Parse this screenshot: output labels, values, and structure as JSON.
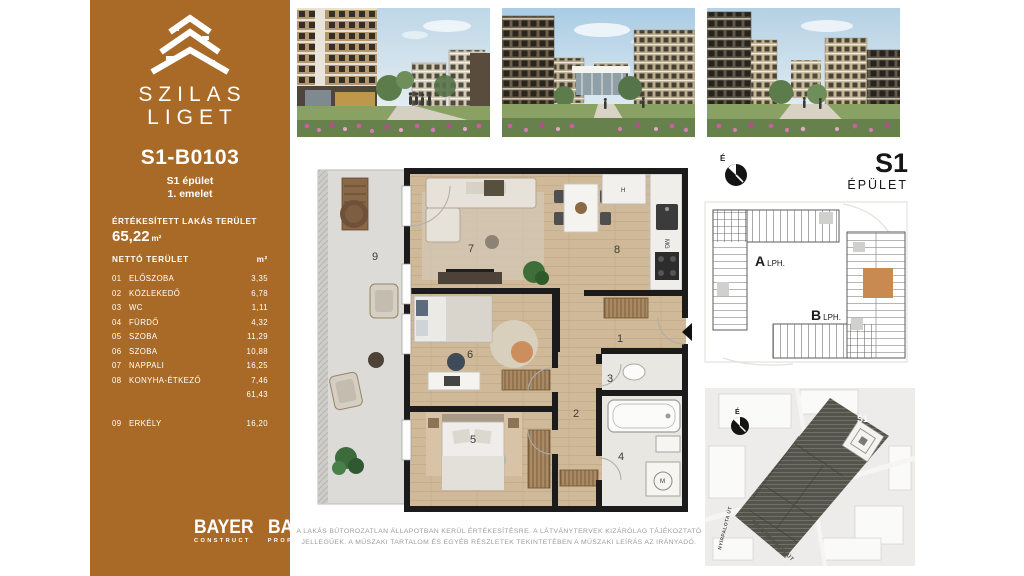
{
  "brand": {
    "line1": "SZILAS",
    "line2": "LIGET"
  },
  "unit": {
    "id": "S1-B0103",
    "building": "S1 épület",
    "floor": "1. emelet"
  },
  "area": {
    "sold_label": "ÉRTÉKESÍTETT LAKÁS TERÜLET",
    "sold_value": "65,22",
    "sold_unit": "m²",
    "net_label": "NETTÓ TERÜLET",
    "net_unit": "m²",
    "rows": [
      {
        "num": "01",
        "name": "ELŐSZOBA",
        "value": "3,35"
      },
      {
        "num": "02",
        "name": "KÖZLEKEDŐ",
        "value": "6,78"
      },
      {
        "num": "03",
        "name": "WC",
        "value": "1,11"
      },
      {
        "num": "04",
        "name": "FÜRDŐ",
        "value": "4,32"
      },
      {
        "num": "05",
        "name": "SZOBA",
        "value": "11,29"
      },
      {
        "num": "06",
        "name": "SZOBA",
        "value": "10,88"
      },
      {
        "num": "07",
        "name": "NAPPALI",
        "value": "16,25"
      },
      {
        "num": "08",
        "name": "KONYHA-ÉTKEZŐ",
        "value": "7,46"
      }
    ],
    "subtotal": "61,43",
    "balcony_row": {
      "num": "09",
      "name": "ERKÉLY",
      "value": "16,20"
    }
  },
  "footer_logos": [
    {
      "name": "BAYER",
      "sub": "CONSTRUCT"
    },
    {
      "name": "BAYER",
      "sub": "PROPERTY"
    }
  ],
  "floorplan": {
    "room_labels": {
      "r1": "1",
      "r2": "2",
      "r3": "3",
      "r4": "4",
      "r5": "5",
      "r6": "6",
      "r7": "7",
      "r8": "8",
      "r9": "9"
    },
    "appliance_labels": {
      "fridge": "H",
      "dishwasher": "MG",
      "washer": "M"
    }
  },
  "building_overview": {
    "north": "É",
    "code": "S1",
    "word": "ÉPÜLET",
    "stair_a_letter": "A",
    "stair_a_word": "LPH.",
    "stair_b_letter": "B",
    "stair_b_word": "LPH."
  },
  "site_map": {
    "north": "É",
    "tag": "S1",
    "street_main": "SZENTMIHÁLYI ÚT",
    "street_side": "NYÍRPALOTA ÚT"
  },
  "disclaimer": "A LAKÁS BÚTOROZATLAN ÁLLAPOTBAN KERÜL ÉRTÉKESÍTÉSRE. A LÁTVÁNYTERVEK KIZÁRÓLAG TÁJÉKOZTATÓ JELLEGŰEK. A MŰSZAKI TARTALOM ÉS EGYÉB RÉSZLETEK TEKINTETÉBEN A MŰSZAKI LEÍRÁS AZ IRÁNYADÓ.",
  "colors": {
    "accent": "#A86A26",
    "unit_highlight": "#C98A52"
  }
}
